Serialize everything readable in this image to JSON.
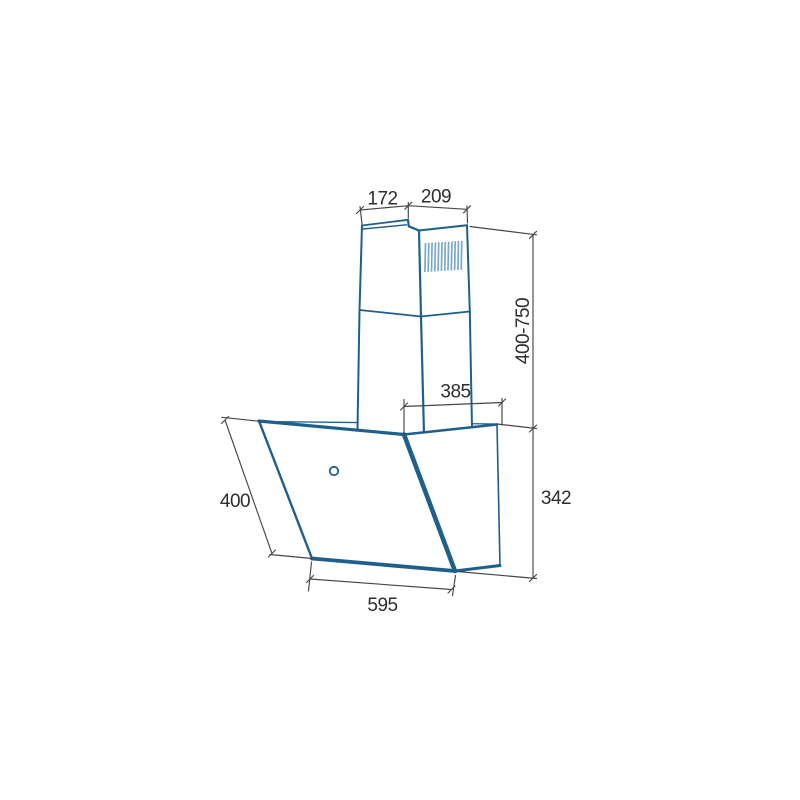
{
  "drawing": {
    "type": "appliance-dimension-diagram",
    "subject": "angled cooker hood with telescopic chimney",
    "units_note": "",
    "dimensions": {
      "chimney_top_depth": "172",
      "chimney_top_width": "209",
      "chimney_height_range": "400-750",
      "body_top_depth": "385",
      "body_side_height": "342",
      "glass_front_length": "400",
      "body_width": "595"
    }
  },
  "colors": {
    "drawing_blue": "#1e5f8c",
    "grille_blue": "#7aa9c7",
    "dimension_gray": "#474747",
    "label_color": "#2e2e2e",
    "background": "#ffffff",
    "face_fill": "#ffffff"
  }
}
